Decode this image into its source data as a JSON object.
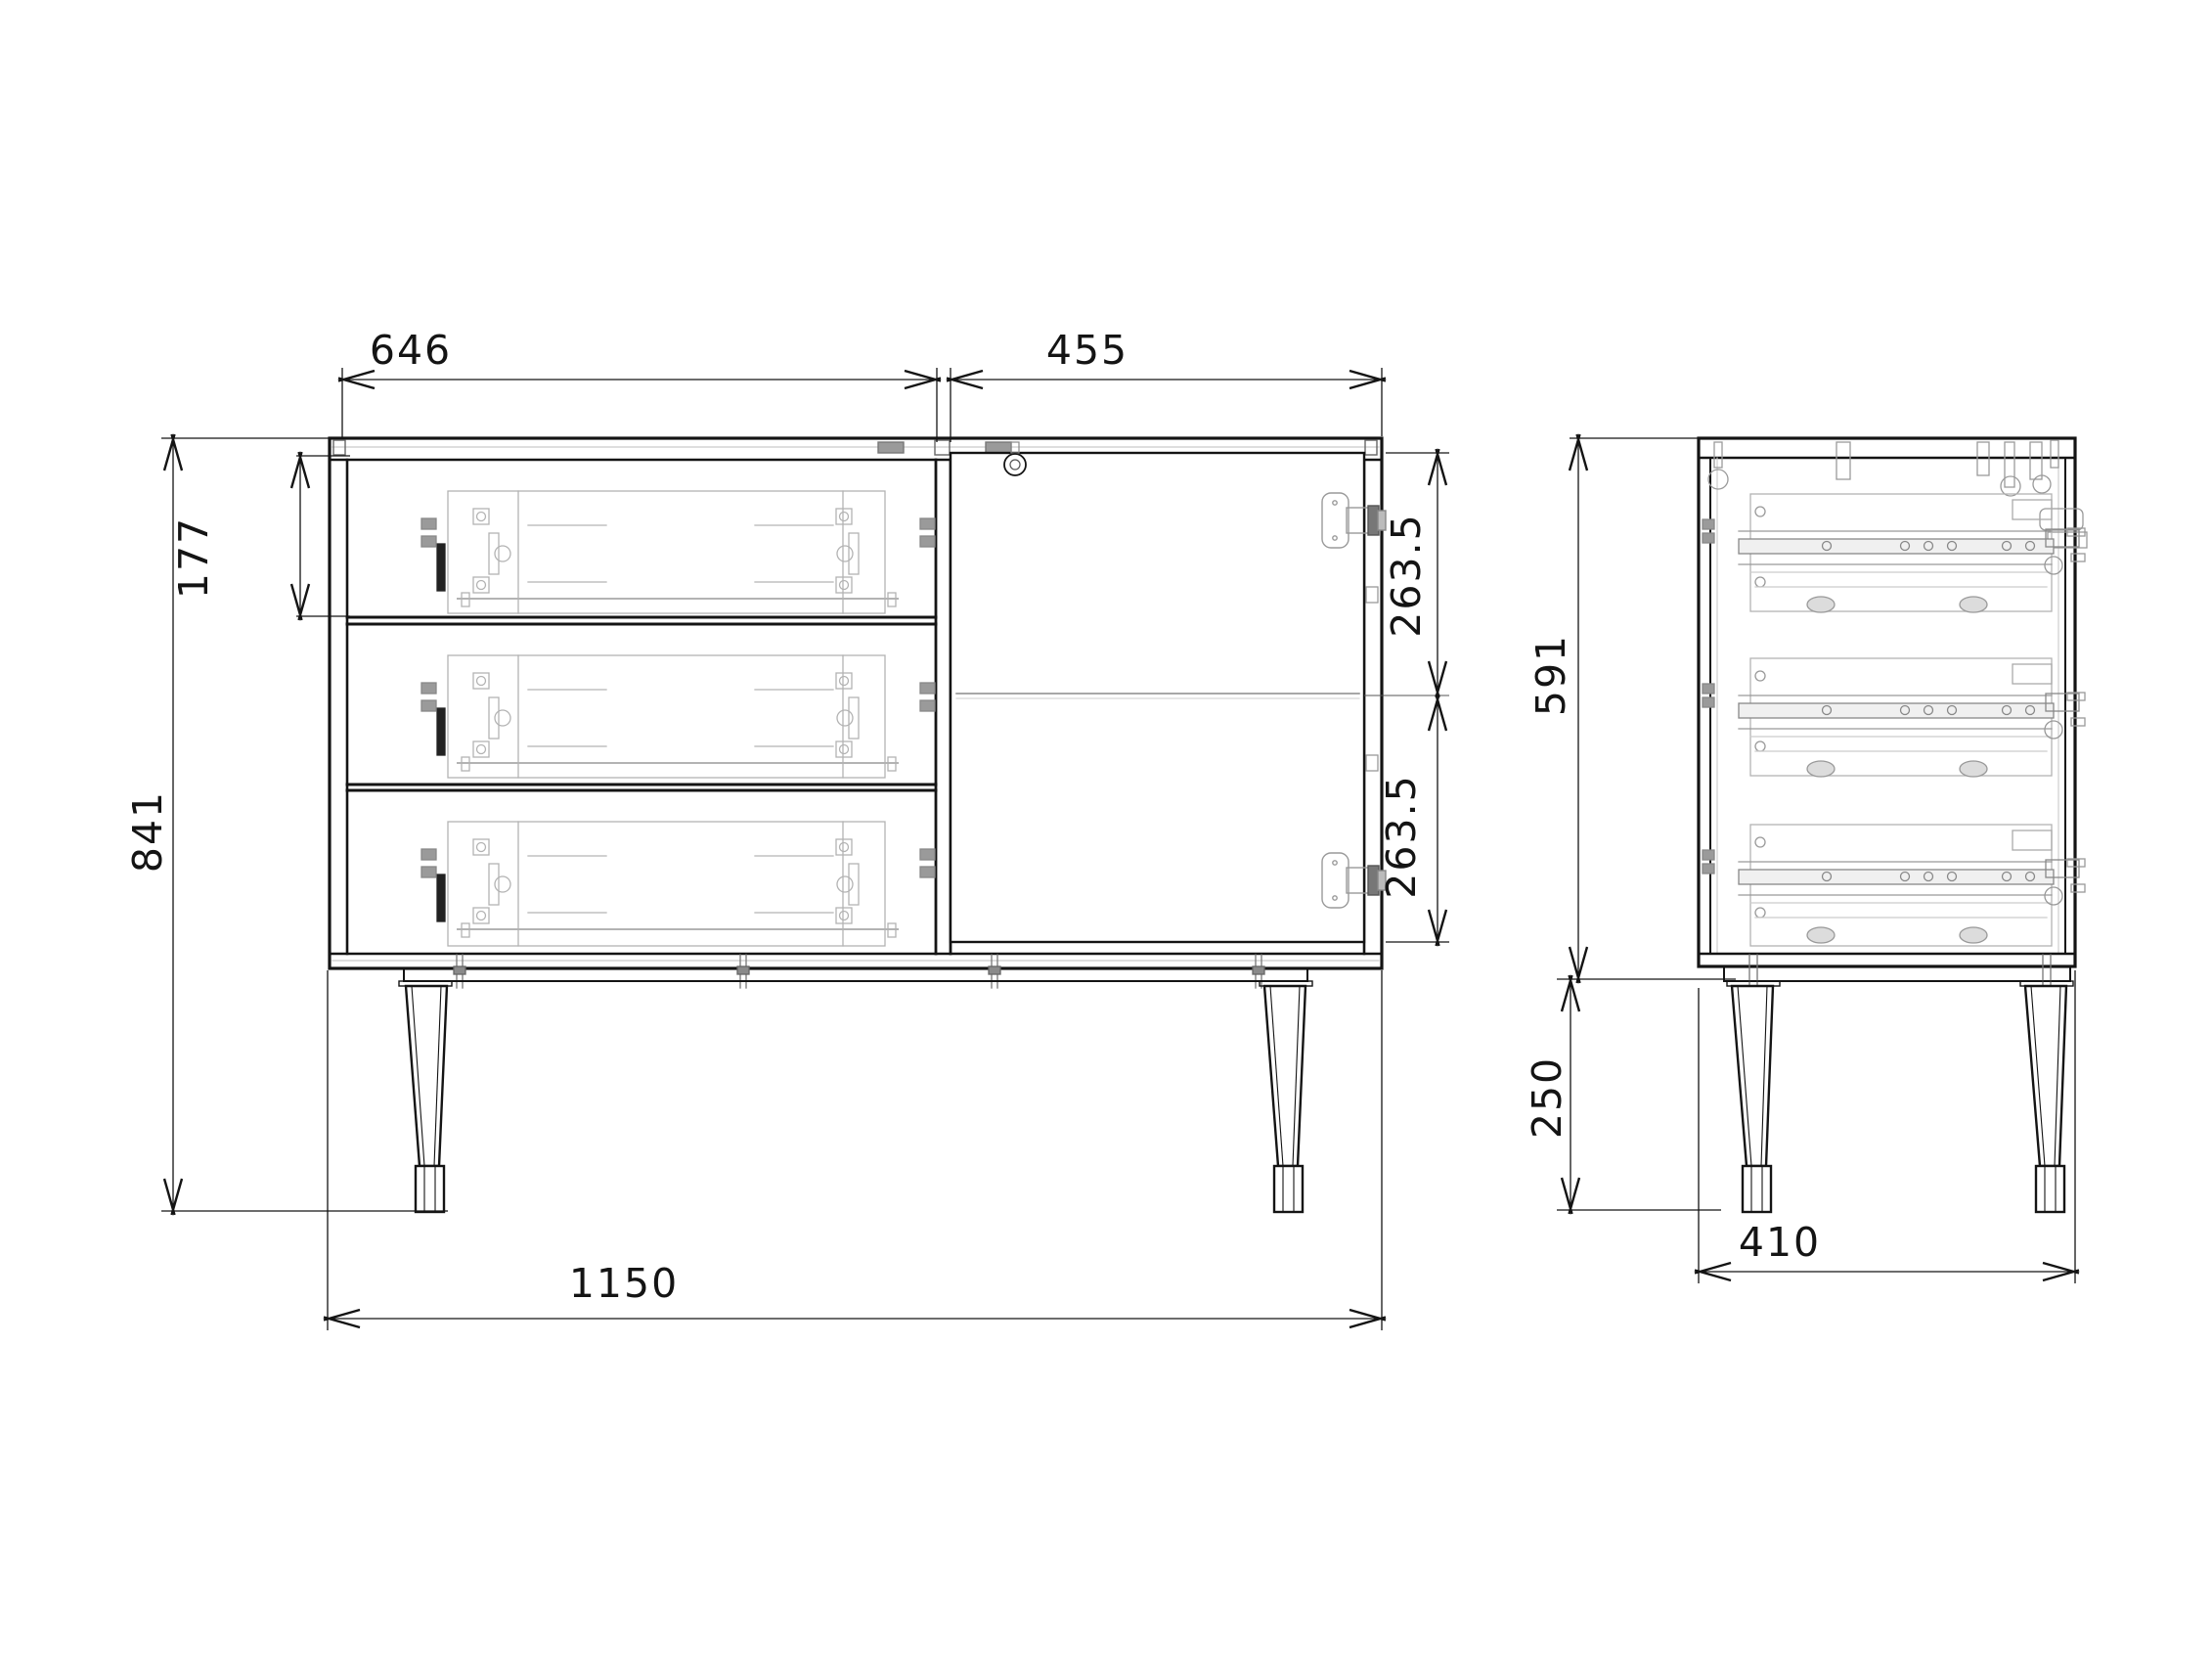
{
  "drawing": {
    "type": "furniture-technical-drawing",
    "subject": "sideboard with three drawers, one hinged door and four tapered legs",
    "background_color": "#ffffff",
    "outline_color": "#141414",
    "hardware_color": "#b3b3b3",
    "views": {
      "front": {
        "name": "front-view",
        "drawer_count": 3,
        "door_count": 1,
        "dimensions": {
          "drawer_section_width": {
            "label": "646",
            "orientation": "horizontal"
          },
          "door_section_width": {
            "label": "455",
            "orientation": "horizontal"
          },
          "drawer_front_height": {
            "label": "177",
            "orientation": "vertical"
          },
          "overall_height": {
            "label": "841",
            "orientation": "vertical"
          },
          "door_upper_half": {
            "label": "263.5",
            "orientation": "vertical"
          },
          "door_lower_half": {
            "label": "263.5",
            "orientation": "vertical"
          },
          "overall_width": {
            "label": "1150",
            "orientation": "horizontal"
          }
        }
      },
      "side": {
        "name": "side-view",
        "dimensions": {
          "carcass_height": {
            "label": "591",
            "orientation": "vertical"
          },
          "leg_height": {
            "label": "250",
            "orientation": "vertical"
          },
          "depth": {
            "label": "410",
            "orientation": "horizontal"
          }
        }
      }
    }
  }
}
